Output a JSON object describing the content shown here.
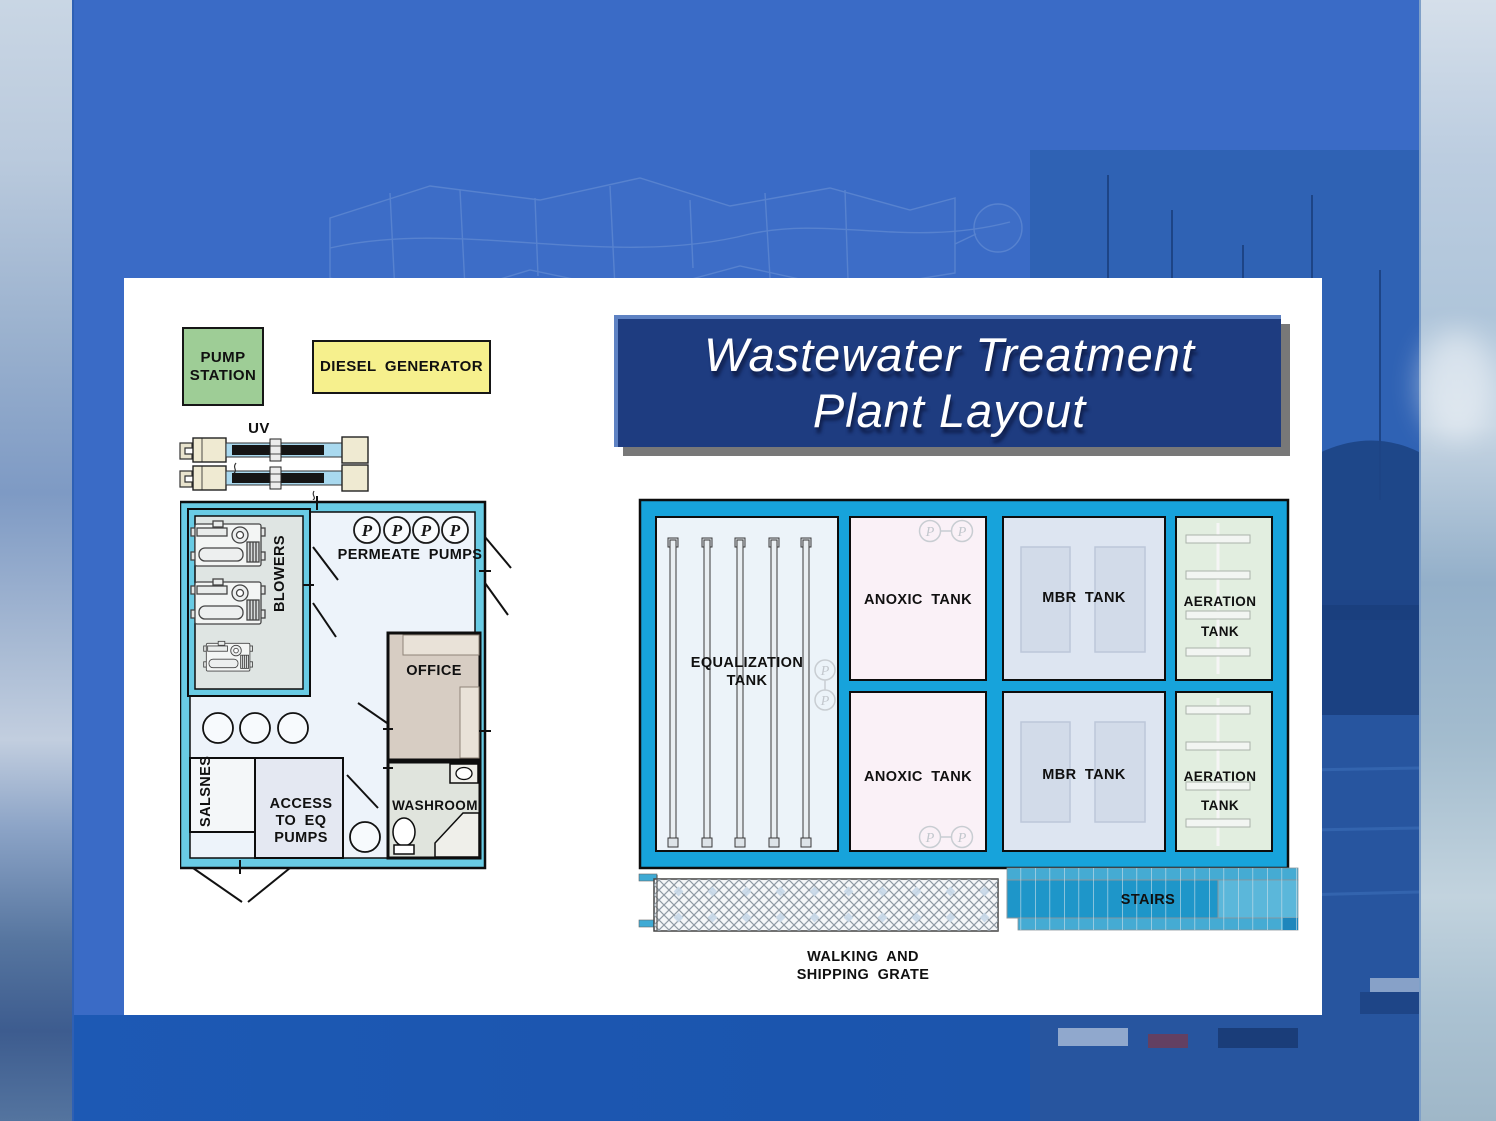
{
  "title": {
    "line1": "Wastewater Treatment",
    "line2": "Plant Layout"
  },
  "site_items": {
    "pump_station_line1": "PUMP",
    "pump_station_line2": "STATION",
    "diesel_generator": "DIESEL GENERATOR",
    "uv": "UV"
  },
  "building": {
    "blowers": "BLOWERS",
    "permeate_pumps": "PERMEATE PUMPS",
    "pump_symbol": "P",
    "office": "OFFICE",
    "washroom": "WASHROOM",
    "salsnes": "SALSNES",
    "access_line1": "ACCESS",
    "access_line2": "TO EQ",
    "access_line3": "PUMPS"
  },
  "plant": {
    "equalization_line1": "EQUALIZATION",
    "equalization_line2": "TANK",
    "anoxic_top": "ANOXIC TANK",
    "anoxic_bottom": "ANOXIC TANK",
    "mbr_top": "MBR TANK",
    "mbr_bottom": "MBR TANK",
    "aeration_line1": "AERATION",
    "aeration_line2": "TANK",
    "pump_symbol": "P",
    "stairs": "STAIRS",
    "grate_line1": "WALKING AND",
    "grate_line2": "SHIPPING GRATE"
  },
  "colors": {
    "slide_bg": "#3A6BC6",
    "panel_bg": "#FFFFFF",
    "title_bg": "#1E3C80",
    "title_text": "#FFFFFF",
    "title_drop_shadow": "#787878",
    "pump_station_fill": "#9ECD96",
    "diesel_fill": "#F6F08D",
    "wall_cyan": "#69CBE4",
    "floor_fill": "#EDF3FA",
    "blower_room_fill": "#DFE5E3",
    "office_fill": "#D7CDC3",
    "washroom_fill": "#E0E4DD",
    "access_fill": "#E4E8F2",
    "frame_blue": "#17A3DB",
    "equalization_fill": "#ECF3F9",
    "anoxic_fill": "#FAF1F7",
    "mbr_fill": "#DDE5F1",
    "aeration_fill": "#E2EEE0",
    "stairs_blue": "#1E96C9"
  }
}
